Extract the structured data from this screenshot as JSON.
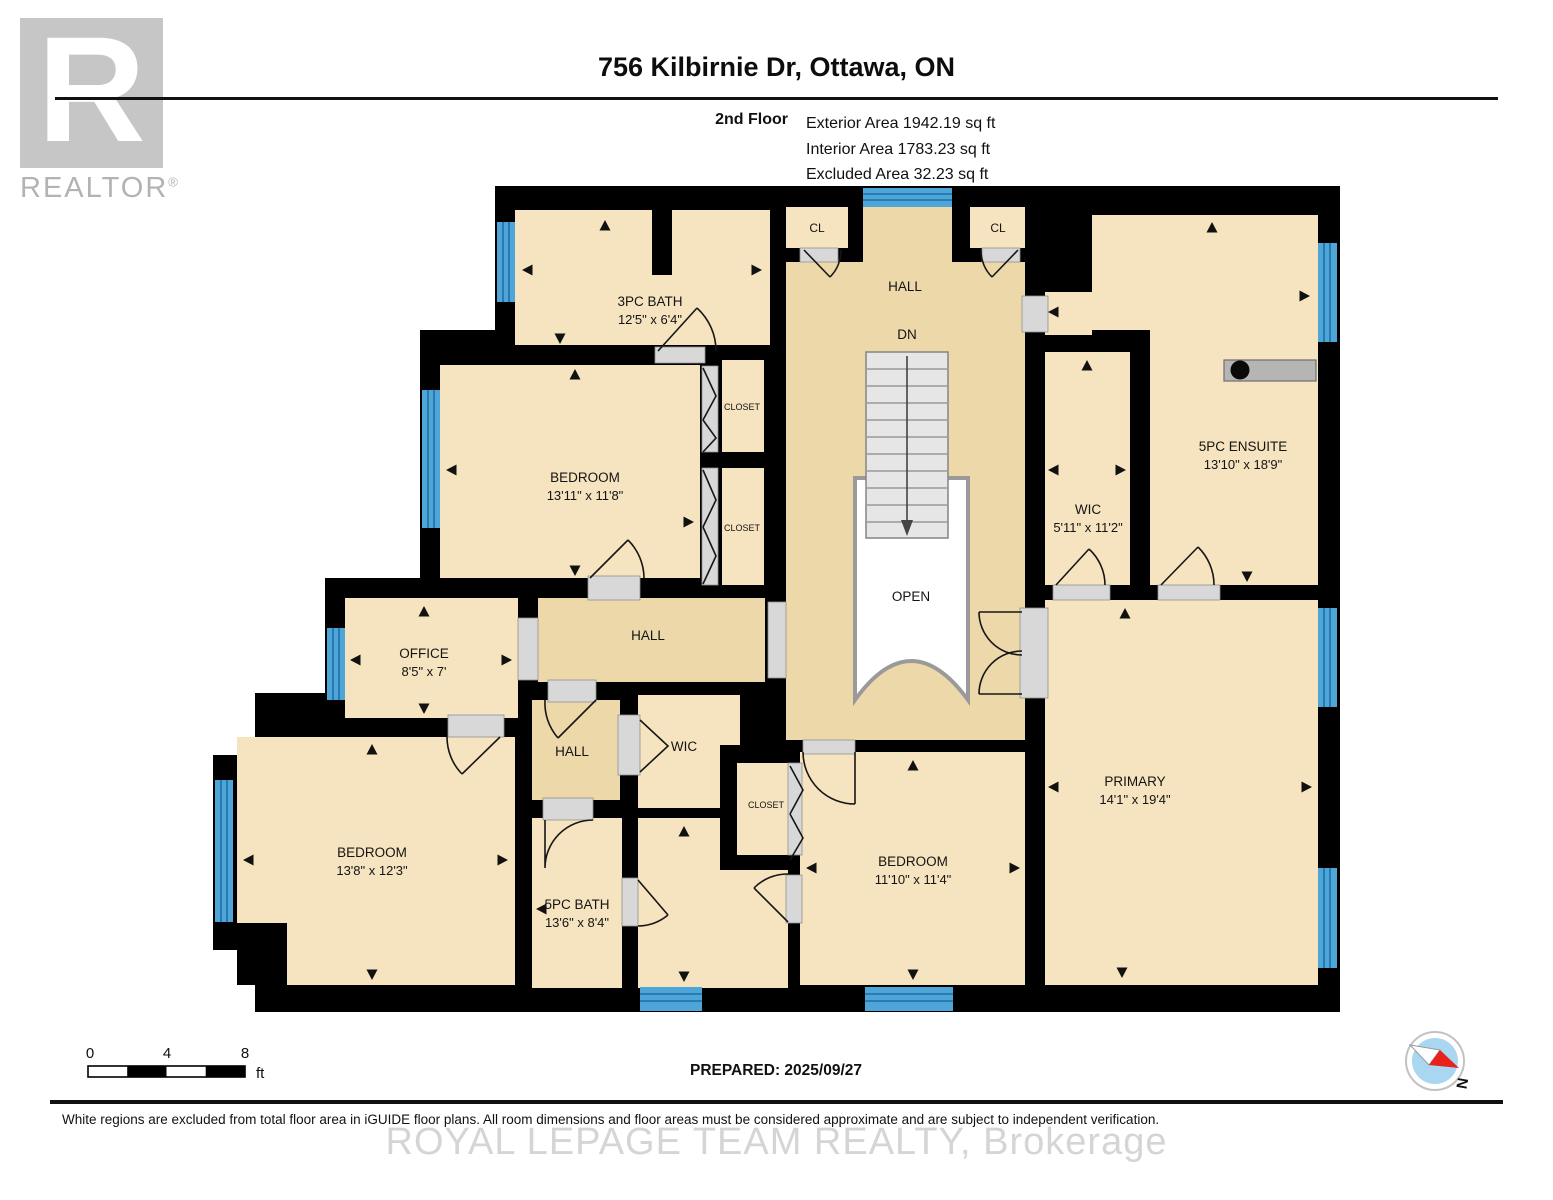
{
  "header": {
    "logo": {
      "letter": "R",
      "word": "REALTOR",
      "reg": "®"
    },
    "title": "756 Kilbirnie Dr, Ottawa, ON",
    "floor": "2nd Floor",
    "exterior_area": "Exterior Area 1942.19 sq ft",
    "interior_area": "Interior Area 1783.23 sq ft",
    "excluded_area": "Excluded Area 32.23 sq ft"
  },
  "plan": {
    "rooms": {
      "bath3": {
        "name": "3PC BATH",
        "dims": "12'5\" x 6'4\""
      },
      "bedroom1": {
        "name": "BEDROOM",
        "dims": "13'11\" x 11'8\""
      },
      "closet1": {
        "name": "CLOSET"
      },
      "closet2": {
        "name": "CLOSET"
      },
      "cl1": {
        "name": "CL"
      },
      "cl2": {
        "name": "CL"
      },
      "hallTop": {
        "name": "HALL"
      },
      "wic": {
        "name": "WIC",
        "dims": "5'11\" x 11'2\""
      },
      "ensuite": {
        "name": "5PC ENSUITE",
        "dims": "13'10\" x 18'9\""
      },
      "office": {
        "name": "OFFICE",
        "dims": "8'5\" x 7'"
      },
      "hallMid": {
        "name": "HALL"
      },
      "hallSmall": {
        "name": "HALL"
      },
      "wicSmall": {
        "name": "WIC"
      },
      "closetMid": {
        "name": "CLOSET"
      },
      "bedroom2": {
        "name": "BEDROOM",
        "dims": "13'8\" x 12'3\""
      },
      "bath5": {
        "name": "5PC BATH",
        "dims": "13'6\" x 8'4\""
      },
      "bedroom3": {
        "name": "BEDROOM",
        "dims": "11'10\" x 11'4\""
      },
      "primary": {
        "name": "PRIMARY",
        "dims": "14'1\" x 19'4\""
      }
    },
    "stairs": {
      "down_label": "DN",
      "open_label": "OPEN"
    }
  },
  "footer": {
    "scale": {
      "t0": "0",
      "t4": "4",
      "t8": "8",
      "unit": "ft"
    },
    "prepared": "PREPARED: 2025/09/27",
    "compass_n": "N",
    "disclaimer": "White regions are excluded from total floor area in iGUIDE floor plans. All room dimensions and floor areas must be considered approximate and are subject to independent verification.",
    "watermark": "ROYAL LEPAGE TEAM REALTY, Brokerage"
  },
  "colors": {
    "room_fill": "#f6e3bf",
    "hall_fill": "#edd8aa",
    "wall": "#000000",
    "window_blue": "#4ea5d8",
    "window_stripe": "#1f6ea6",
    "opening_gray": "#d8d8d8",
    "stair_gray": "#e6e6e6",
    "compass_blue": "#a9d6f0",
    "compass_red": "#e8211d"
  }
}
